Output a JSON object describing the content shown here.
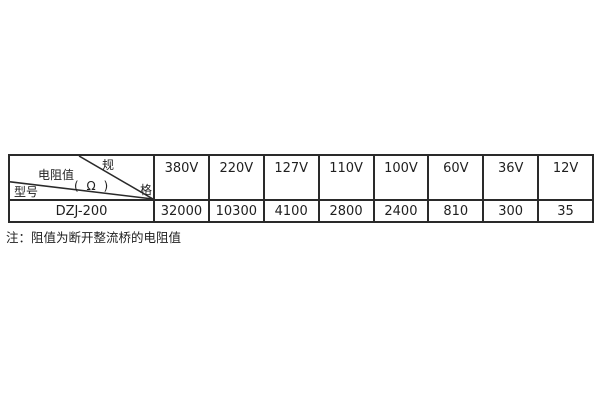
{
  "page": {
    "background": "#ffffff",
    "text_color": "#1f1f1f",
    "border_color": "#2a2a2a"
  },
  "table": {
    "corner": {
      "spec_label_char1": "规",
      "spec_label_char2": "格",
      "resistance_label": "电阻值",
      "unit_label": "( Ω )",
      "model_label": "型号"
    },
    "columns": [
      "380V",
      "220V",
      "127V",
      "110V",
      "100V",
      "60V",
      "36V",
      "12V"
    ],
    "row": {
      "model": "DZJ-200",
      "values": [
        "32000",
        "10300",
        "4100",
        "2800",
        "2400",
        "810",
        "300",
        "35"
      ]
    },
    "note": "注：阻值为断开整流桥的电阻值"
  },
  "chart_data": {
    "type": "table",
    "title": "",
    "corner_header": {
      "top_right": "规格",
      "middle": "电阻值(Ω)",
      "bottom_left": "型号"
    },
    "columns": [
      "380V",
      "220V",
      "127V",
      "110V",
      "100V",
      "60V",
      "36V",
      "12V"
    ],
    "rows": [
      {
        "model": "DZJ-200",
        "values": [
          32000,
          10300,
          4100,
          2800,
          2400,
          810,
          300,
          35
        ]
      }
    ],
    "note": "注：阻值为断开整流桥的电阻值",
    "layout_hints": {
      "header_row_height_px": 45,
      "data_row_height_px": 22,
      "corner_cell_split": "two diagonal lines converging at bottom-right corner"
    }
  }
}
